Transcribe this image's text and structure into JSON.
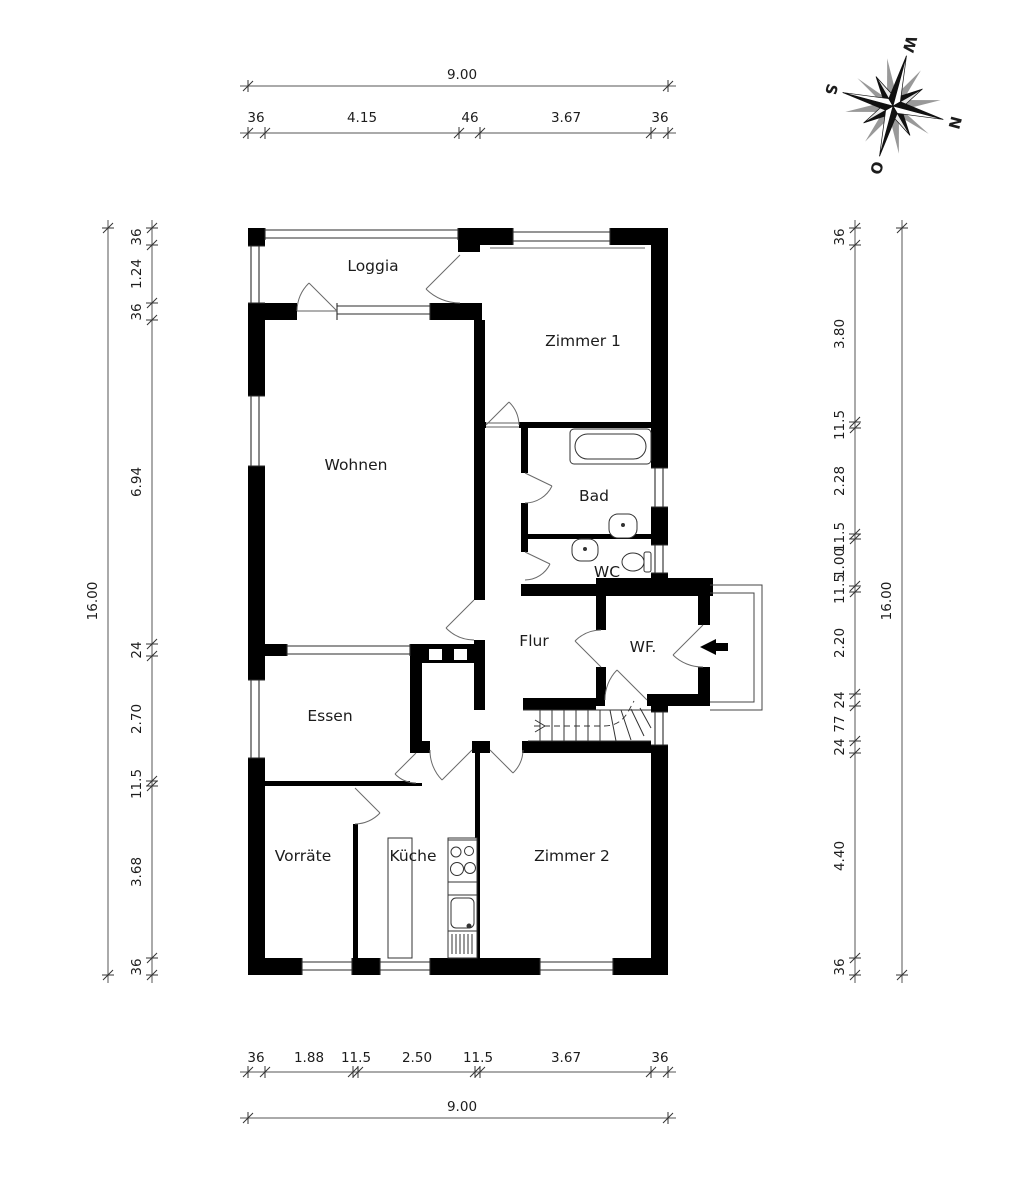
{
  "rooms": {
    "loggia": "Loggia",
    "zimmer1": "Zimmer 1",
    "wohnen": "Wohnen",
    "bad": "Bad",
    "wc": "WC",
    "flur": "Flur",
    "wf": "WF.",
    "essen": "Essen",
    "vorraete": "Vorräte",
    "kueche": "Küche",
    "zimmer2": "Zimmer 2"
  },
  "compass": {
    "n": "N",
    "o": "O",
    "s": "S",
    "w": "W"
  },
  "dimensions": {
    "top": {
      "total": "9.00",
      "segments": [
        "36",
        "4.15",
        "46",
        "3.67",
        "36"
      ]
    },
    "bottom": {
      "total": "9.00",
      "segments": [
        "36",
        "1.88",
        "11.5",
        "2.50",
        "11.5",
        "3.67",
        "36"
      ]
    },
    "left": {
      "total": "16.00",
      "segments": [
        "36",
        "1.24",
        "36",
        "6.94",
        "24",
        "2.70",
        "11.5",
        "3.68",
        "36"
      ]
    },
    "right": {
      "total": "16.00",
      "segments": [
        "36",
        "3.80",
        "11.5",
        "2.28",
        "11.5",
        "1.00",
        "11.5",
        "2.20",
        "24",
        "77",
        "24",
        "4.40",
        "36"
      ]
    }
  },
  "colors": {
    "wall": "#000000",
    "line": "#333333",
    "background": "#ffffff",
    "compass_shadow": "#999999"
  }
}
